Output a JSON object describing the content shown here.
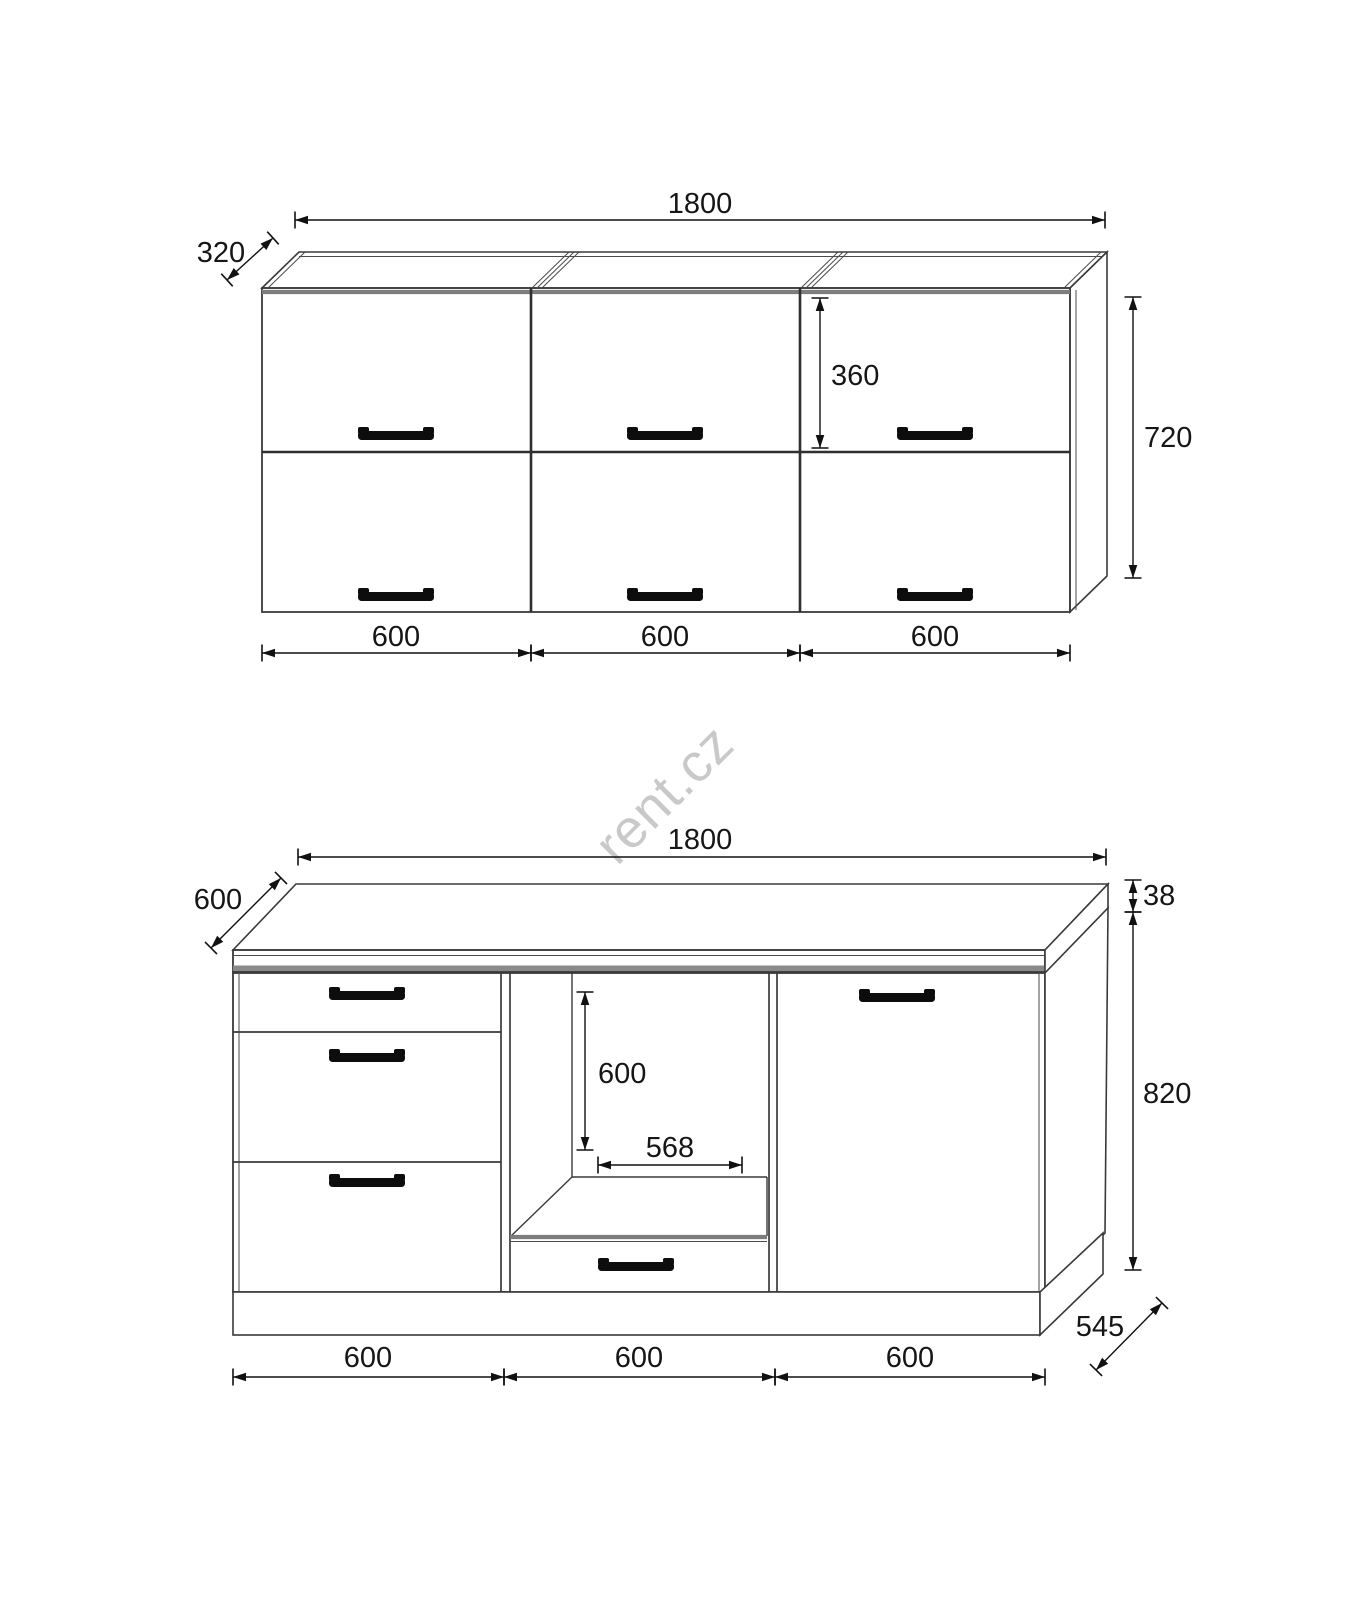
{
  "watermark": {
    "text": "rent.cz",
    "color": "#c9c9c9"
  },
  "upper_view": {
    "name": "wall-cabinet-front-view",
    "dimensions": {
      "total_width": "1800",
      "depth": "320",
      "door_height": "360",
      "total_height": "720",
      "section_widths": [
        "600",
        "600",
        "600"
      ]
    }
  },
  "lower_view": {
    "name": "base-cabinet-front-view",
    "dimensions": {
      "total_width": "1800",
      "worktop_depth": "600",
      "worktop_thickness": "38",
      "niche_height": "600",
      "niche_width": "568",
      "body_height": "820",
      "body_depth": "545",
      "section_widths": [
        "600",
        "600",
        "600"
      ]
    }
  }
}
